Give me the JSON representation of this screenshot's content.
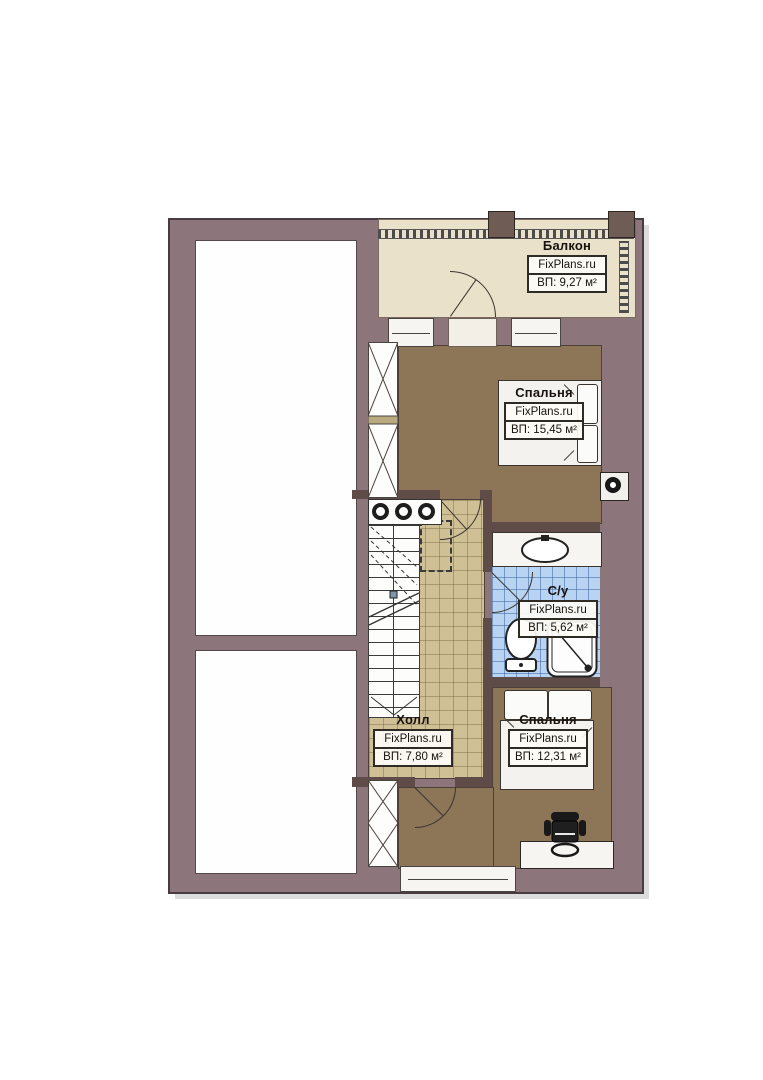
{
  "rooms": {
    "balcony": {
      "name": "Балкон",
      "brand": "FixPlans.ru",
      "area": "ВП: 9,27 м²"
    },
    "bedroom_top": {
      "name": "Спальня",
      "brand": "FixPlans.ru",
      "area": "ВП: 15,45 м²"
    },
    "bathroom": {
      "name": "С/у",
      "brand": "FixPlans.ru",
      "area": "ВП: 5,62 м²"
    },
    "hall": {
      "name": "Холл",
      "brand": "FixPlans.ru",
      "area": "ВП: 7,80 м²"
    },
    "bedroom_bottom": {
      "name": "Спальня",
      "brand": "FixPlans.ru",
      "area": "ВП: 12,31 м²"
    }
  },
  "colors": {
    "wall": "#8c767b",
    "balcony_floor": "#eae1cb",
    "bedroom_floor": "#8d7557",
    "hall_floor": "#cfc096",
    "bathroom_tile": "#b8d4f2"
  }
}
